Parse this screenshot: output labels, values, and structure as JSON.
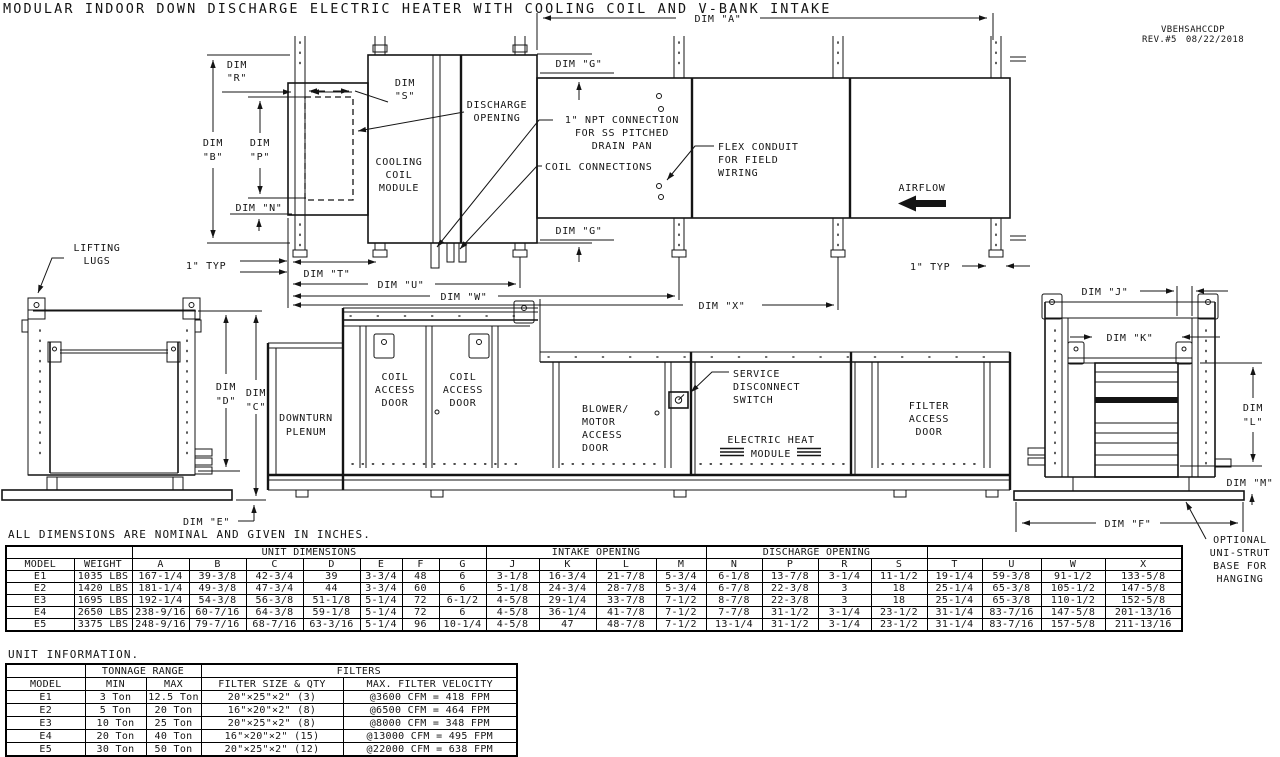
{
  "title": "MODULAR INDOOR DOWN DISCHARGE ELECTRIC HEATER WITH COOLING COIL AND V-BANK INTAKE",
  "revision": {
    "model_code": "VBEHSAHCCDP",
    "rev": "REV.#5",
    "date": "08/22/2018"
  },
  "dims": {
    "a": "DIM \"A\"",
    "b": [
      "DIM",
      "\"B\""
    ],
    "c": [
      "DIM",
      "\"C\""
    ],
    "d": [
      "DIM",
      "\"D\""
    ],
    "e": "DIM \"E\"",
    "f": "DIM \"F\"",
    "g": "DIM \"G\"",
    "j": "DIM \"J\"",
    "k": "DIM \"K\"",
    "l": [
      "DIM",
      "\"L\""
    ],
    "m": "DIM \"M\"",
    "n": "DIM \"N\"",
    "p": [
      "DIM",
      "\"P\""
    ],
    "r": [
      "DIM",
      "\"R\""
    ],
    "s": [
      "DIM",
      "\"S\""
    ],
    "t": "DIM \"T\"",
    "u": "DIM \"U\"",
    "w": "DIM \"W\"",
    "x": "DIM \"X\""
  },
  "labels": {
    "one_inch_typ": "1\" TYP",
    "discharge_opening": [
      "DISCHARGE",
      "OPENING"
    ],
    "cooling_coil_module": [
      "COOLING",
      "COIL",
      "MODULE"
    ],
    "npt": [
      "1\" NPT CONNECTION",
      "FOR SS PITCHED",
      "DRAIN PAN"
    ],
    "coil_connections": "COIL CONNECTIONS",
    "flex_conduit": [
      "FLEX CONDUIT",
      "FOR FIELD",
      "WIRING"
    ],
    "airflow": "AIRFLOW",
    "lifting_lugs": [
      "LIFTING",
      "LUGS"
    ],
    "downturn_plenum": [
      "DOWNTURN",
      "PLENUM"
    ],
    "coil_access_door": [
      "COIL",
      "ACCESS",
      "DOOR"
    ],
    "blower_motor_access_door": [
      "BLOWER/",
      "MOTOR",
      "ACCESS",
      "DOOR"
    ],
    "service_disconnect": [
      "SERVICE",
      "DISCONNECT",
      "SWITCH"
    ],
    "electric_heat_module": [
      "ELECTRIC HEAT",
      "MODULE"
    ],
    "filter_access_door": [
      "FILTER",
      "ACCESS",
      "DOOR"
    ],
    "optional_unistrut": [
      "OPTIONAL",
      "UNI-STRUT",
      "BASE FOR",
      "HANGING"
    ]
  },
  "notes": {
    "dimensions": "ALL DIMENSIONS ARE NOMINAL AND GIVEN IN INCHES.",
    "unit_information": "UNIT INFORMATION."
  },
  "dim_table": {
    "group_headers": {
      "unit_dimensions": "UNIT DIMENSIONS",
      "intake_opening": "INTAKE OPENING",
      "discharge_opening": "DISCHARGE OPENING"
    },
    "columns": [
      "MODEL",
      "WEIGHT",
      "A",
      "B",
      "C",
      "D",
      "E",
      "F",
      "G",
      "J",
      "K",
      "L",
      "M",
      "N",
      "P",
      "R",
      "S",
      "T",
      "U",
      "W",
      "X"
    ],
    "rows": [
      [
        "E1",
        "1035 LBS",
        "167-1/4",
        "39-3/8",
        "42-3/4",
        "39",
        "3-3/4",
        "48",
        "6",
        "3-1/8",
        "16-3/4",
        "21-7/8",
        "5-3/4",
        "6-1/8",
        "13-7/8",
        "3-1/4",
        "11-1/2",
        "19-1/4",
        "59-3/8",
        "91-1/2",
        "133-5/8"
      ],
      [
        "E2",
        "1420 LBS",
        "181-1/4",
        "49-3/8",
        "47-3/4",
        "44",
        "3-3/4",
        "60",
        "6",
        "5-1/8",
        "24-3/4",
        "28-7/8",
        "5-3/4",
        "6-7/8",
        "22-3/8",
        "3",
        "18",
        "25-1/4",
        "65-3/8",
        "105-1/2",
        "147-5/8"
      ],
      [
        "E3",
        "1695 LBS",
        "192-1/4",
        "54-3/8",
        "56-3/8",
        "51-1/8",
        "5-1/4",
        "72",
        "6-1/2",
        "4-5/8",
        "29-1/4",
        "33-7/8",
        "7-1/2",
        "8-7/8",
        "22-3/8",
        "3",
        "18",
        "25-1/4",
        "65-3/8",
        "110-1/2",
        "152-5/8"
      ],
      [
        "E4",
        "2650 LBS",
        "238-9/16",
        "60-7/16",
        "64-3/8",
        "59-1/8",
        "5-1/4",
        "72",
        "6",
        "4-5/8",
        "36-1/4",
        "41-7/8",
        "7-1/2",
        "7-7/8",
        "31-1/2",
        "3-1/4",
        "23-1/2",
        "31-1/4",
        "83-7/16",
        "147-5/8",
        "201-13/16"
      ],
      [
        "E5",
        "3375 LBS",
        "248-9/16",
        "79-7/16",
        "68-7/16",
        "63-3/16",
        "5-1/4",
        "96",
        "10-1/4",
        "4-5/8",
        "47",
        "48-7/8",
        "7-1/2",
        "13-1/4",
        "31-1/2",
        "3-1/4",
        "23-1/2",
        "31-1/4",
        "83-7/16",
        "157-5/8",
        "211-13/16"
      ]
    ]
  },
  "unit_table": {
    "group_headers": {
      "tonnage_range": "TONNAGE RANGE",
      "filters": "FILTERS"
    },
    "columns": [
      "MODEL",
      "MIN",
      "MAX",
      "FILTER SIZE & QTY",
      "MAX. FILTER VELOCITY"
    ],
    "rows": [
      [
        "E1",
        "3 Ton",
        "12.5 Ton",
        "20\"×25\"×2\" (3)",
        "@3600 CFM = 418 FPM"
      ],
      [
        "E2",
        "5 Ton",
        "20 Ton",
        "16\"×20\"×2\" (8)",
        "@6500 CFM = 464 FPM"
      ],
      [
        "E3",
        "10 Ton",
        "25 Ton",
        "20\"×25\"×2\" (8)",
        "@8000 CFM = 348 FPM"
      ],
      [
        "E4",
        "20 Ton",
        "40 Ton",
        "16\"×20\"×2\" (15)",
        "@13000 CFM = 495 FPM"
      ],
      [
        "E5",
        "30 Ton",
        "50 Ton",
        "20\"×25\"×2\" (12)",
        "@22000 CFM = 638 FPM"
      ]
    ]
  }
}
